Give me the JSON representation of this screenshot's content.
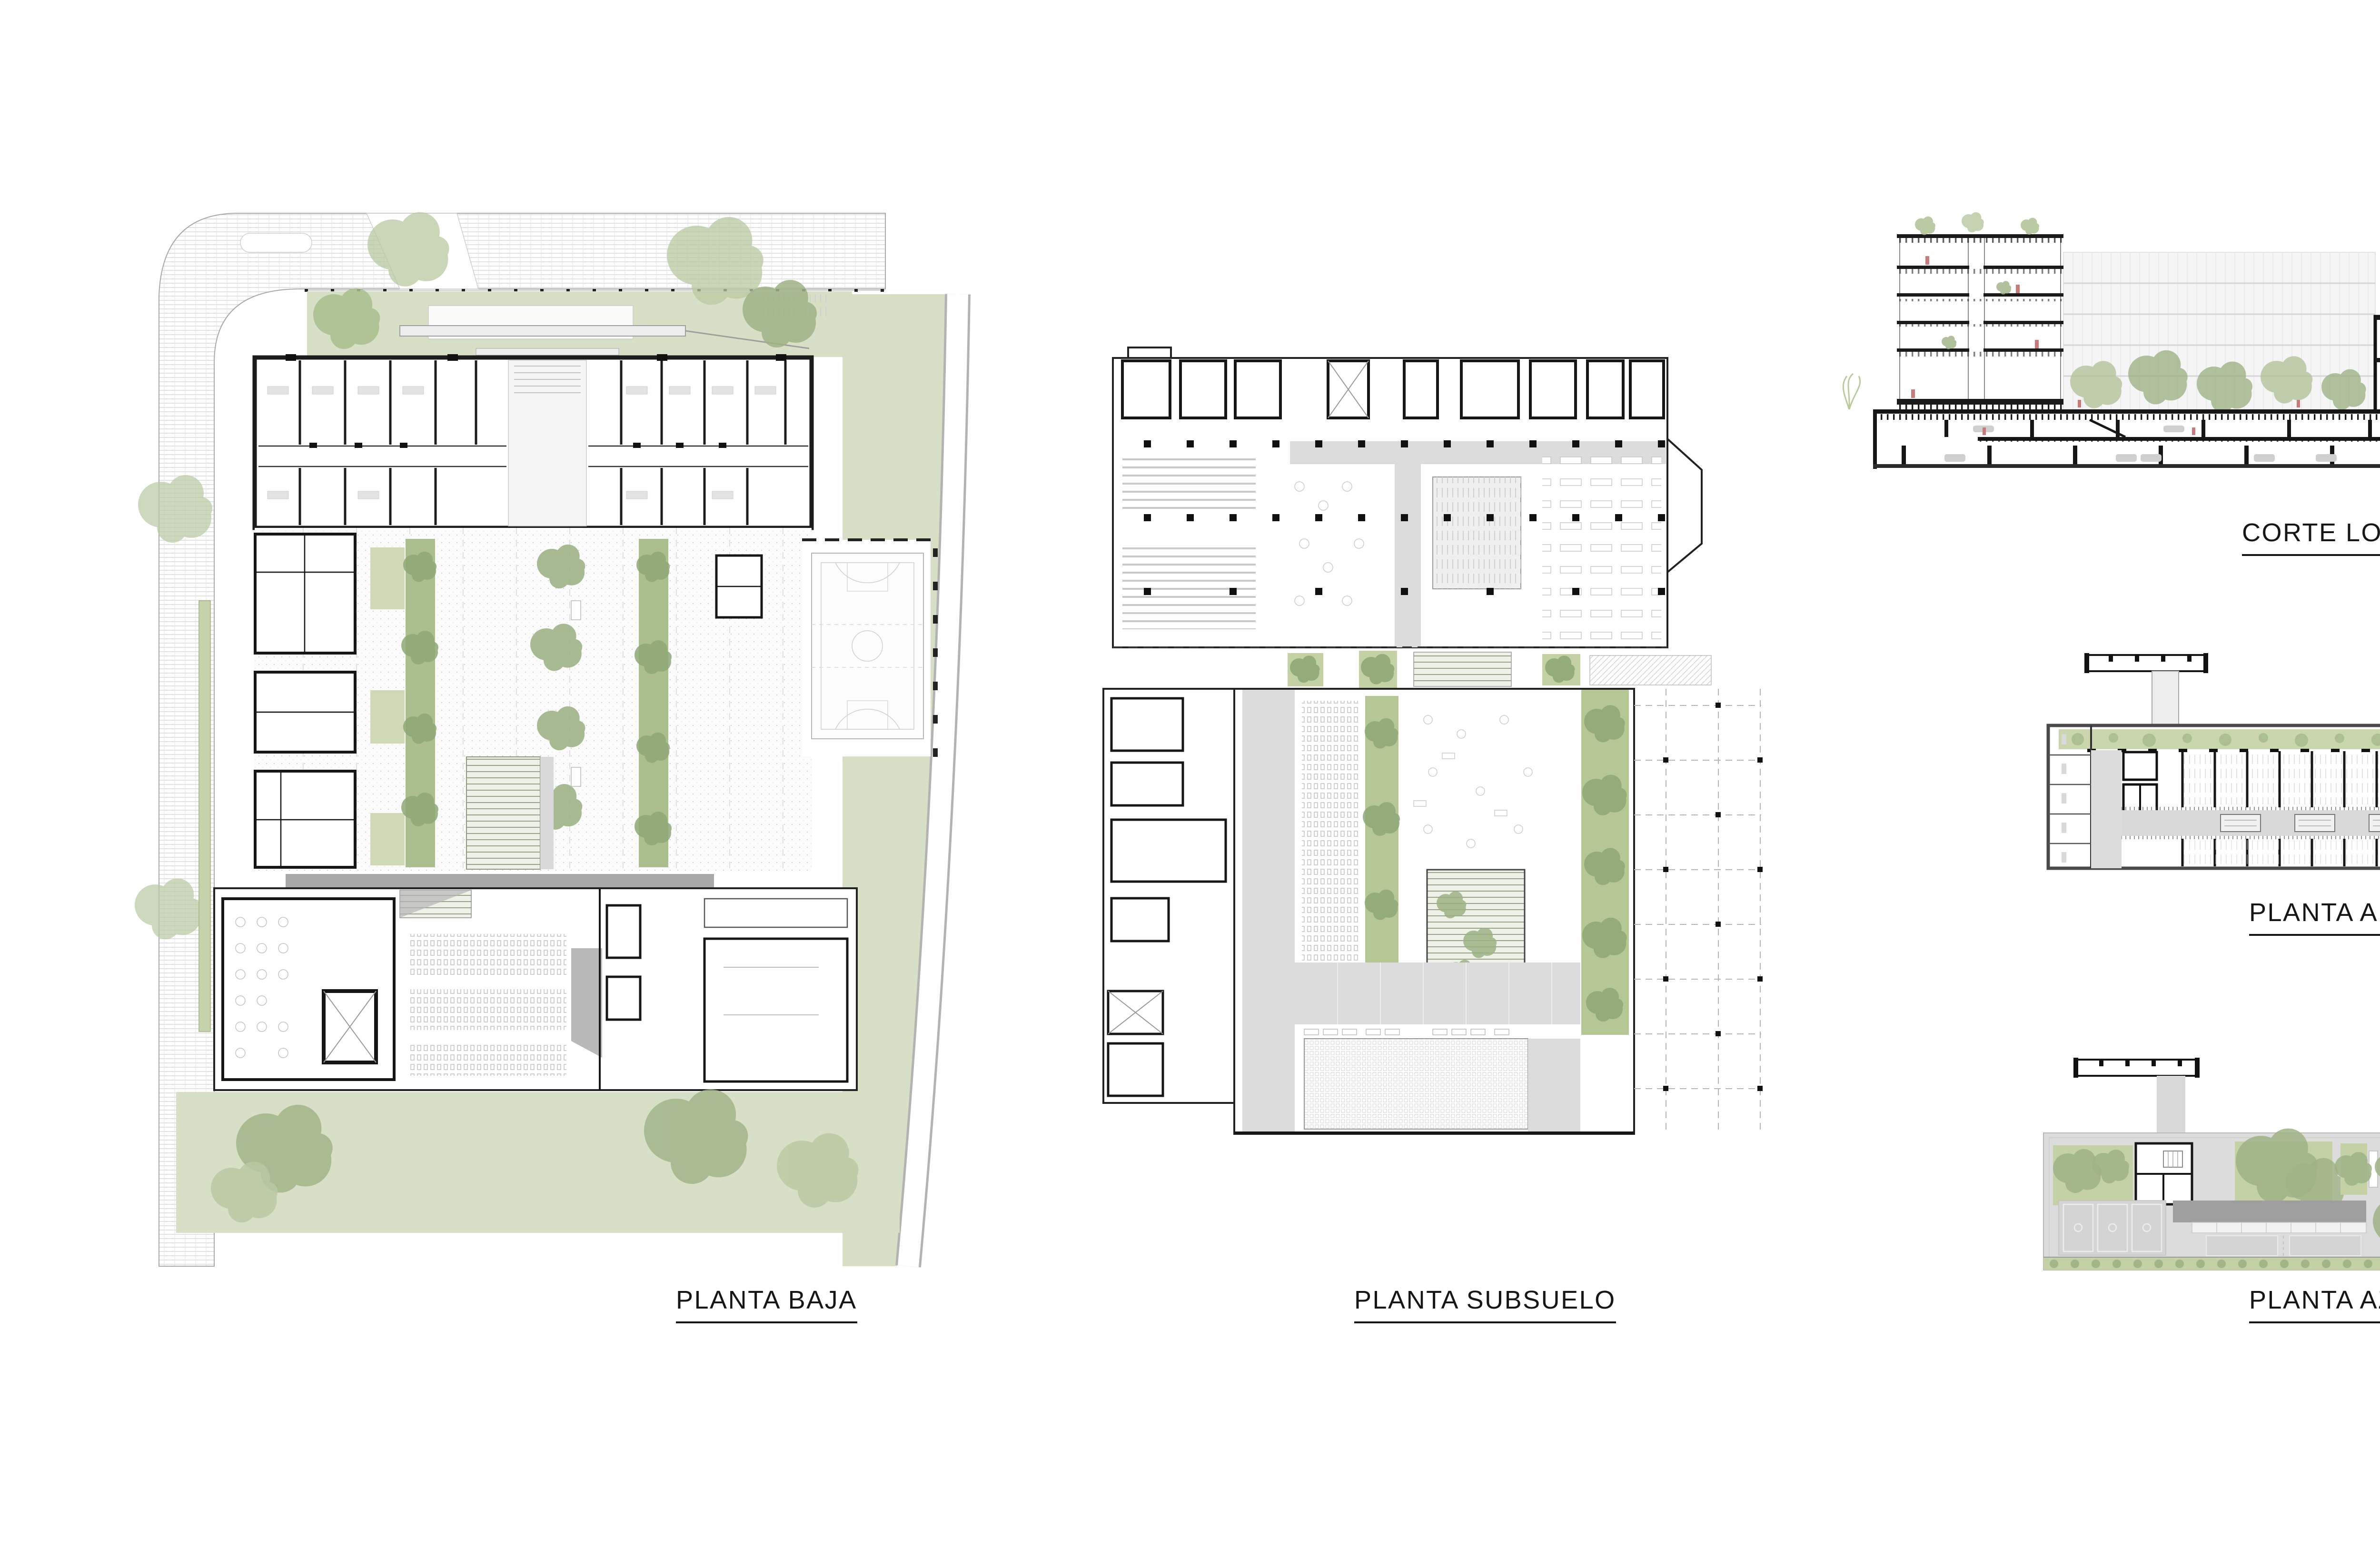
{
  "sheet": {
    "background": "#ffffff",
    "kind": "architectural presentation sheet"
  },
  "drawings": [
    {
      "id": "planta-baja",
      "label": "PLANTA BAJA",
      "kind": "ground floor plan"
    },
    {
      "id": "planta-subsuelo",
      "label": "PLANTA SUBSUELO",
      "kind": "basement floor plan"
    },
    {
      "id": "corte-longitudinal",
      "label": "CORTE LONGITUDINAL",
      "kind": "longitudinal section"
    },
    {
      "id": "planta-aulas",
      "label": "PLANTA AULAS",
      "kind": "classroom floor plan"
    },
    {
      "id": "planta-azotea",
      "label": "PLANTA AZOTEA",
      "kind": "roof plan"
    }
  ],
  "palette": {
    "ink": "#1a1a1a",
    "wall_gray": "#4a4a4a",
    "paving_gray": "#dcdcdc",
    "mid_gray": "#9f9f9f",
    "line_light": "#b5b5b5",
    "lawn_green": "#d7dfc6",
    "planter_green": "#c3d1a4",
    "strip_green": "#aabf8d",
    "tree_green": "#9fb386",
    "accent_red": "#c97b7b",
    "facade_gray": "#f4f4f4"
  }
}
